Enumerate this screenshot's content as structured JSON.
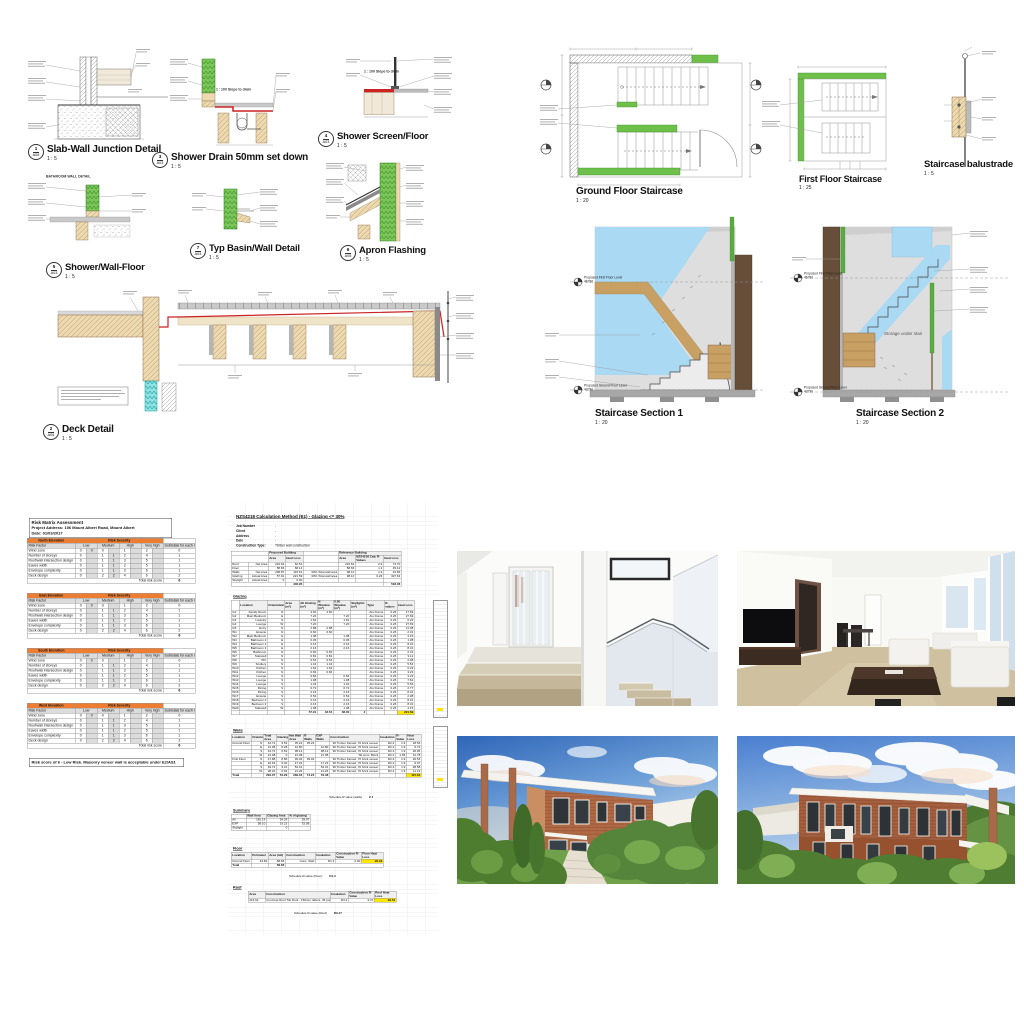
{
  "colors": {
    "accent_orange": "#ED7D31",
    "highlight_yellow": "#FFE600",
    "drawing_green": "#6EC04B",
    "section_blue": "#AAD9F3",
    "timber_tan": "#C8A064",
    "wall_brown": "#5A4532",
    "membrane_red": "#CC2222",
    "insulation_cyan": "#8FE3E3"
  },
  "details_sheet": {
    "bathroom_label": "BATHROOM WALL DETAIL",
    "slope_note": "1 : 100 Slope to drain",
    "details": [
      {
        "num": "1",
        "sheet": "A05",
        "title": "Slab-Wall Junction Detail",
        "scale": "1 : 5"
      },
      {
        "num": "3",
        "sheet": "A03",
        "title": "Shower Drain 50mm set down",
        "scale": "1 : 5"
      },
      {
        "num": "4",
        "sheet": "A03",
        "title": "Shower Screen/Floor",
        "scale": "1 : 5"
      },
      {
        "num": "5",
        "sheet": "A03",
        "title": "Shower/Wall-Floor",
        "scale": "1 : 5"
      },
      {
        "num": "7",
        "sheet": "A03",
        "title": "Typ Basin/Wall Detail",
        "scale": "1 : 5"
      },
      {
        "num": "6",
        "sheet": "A05",
        "title": "Apron Flashing",
        "scale": "1 : 5"
      },
      {
        "num": "2",
        "sheet": "A05",
        "title": "Deck Detail",
        "scale": "1 : 5"
      }
    ]
  },
  "stair_sheet": {
    "plans": [
      {
        "title": "Ground Floor Staircase",
        "scale": "1 : 20"
      },
      {
        "title": "First Floor Staircase",
        "scale": "1 : 25"
      },
      {
        "title": "Staircase balustrade",
        "scale": "1 : 5"
      }
    ],
    "sections": [
      {
        "title": "Staircase Section 1",
        "scale": "1 : 20"
      },
      {
        "title": "Staircase Section 2",
        "scale": "1 : 20"
      }
    ],
    "levels": {
      "first_floor": "Proposed First Floor Level",
      "first_floor_value": "46780",
      "ground_floor": "Proposed Ground Floor Level",
      "ground_floor_value": "43790"
    },
    "storage_note": "Storage under stair"
  },
  "risk_matrix": {
    "title": "Risk Matrix Assessment",
    "address": "Project Address: 106 Mount Albert Road, Mount Albert",
    "date": "Date: 01/03/2017",
    "note": "Risk score of 6 - Low Risk. Masonry veneer wall is acceptable under E2/AS1",
    "tables": [
      {
        "cells": [
          [
            "#North Elevation",
            "#@8@Risk Severity",
            ""
          ],
          [
            "~Risk Factor",
            "~@2@Low",
            "~@2@Medium",
            "~@2@High",
            "~@2@Very high",
            "~Subtotals for each risk factor"
          ],
          [
            "Wind zone",
            "0",
            "~0",
            "0",
            "~",
            "1",
            "~",
            "2",
            "~",
            "0"
          ],
          [
            "Number of storeys",
            "0",
            "~",
            "1",
            "~1",
            "2",
            "~",
            "4",
            "~",
            "1"
          ],
          [
            "Roof/wall intersection design",
            "0",
            "~",
            "1",
            "~1",
            "3",
            "~",
            "5",
            "~",
            "1"
          ],
          [
            "Eaves width",
            "0",
            "~",
            "1",
            "~1",
            "2",
            "~",
            "5",
            "~",
            "1"
          ],
          [
            "Envelope complexity",
            "0",
            "~",
            "1",
            "~1",
            "3",
            "~",
            "6",
            "~",
            "1"
          ],
          [
            "Deck design",
            "0",
            "~",
            "2",
            "~2",
            "4",
            "~",
            "6",
            "~",
            "2"
          ],
          [
            "$@9@Total risk score",
            "^6"
          ]
        ]
      },
      {
        "cells": [
          [
            "#East Elevation",
            "#@8@Risk Severity",
            ""
          ],
          [
            "~Risk Factor",
            "~@2@Low",
            "~@2@Medium",
            "~@2@High",
            "~@2@Very high",
            "~Subtotals for each risk factor"
          ],
          [
            "Wind zone",
            "0",
            "~0",
            "0",
            "~",
            "1",
            "~",
            "2",
            "~",
            "0"
          ],
          [
            "Number of storeys",
            "0",
            "~",
            "1",
            "~1",
            "2",
            "~",
            "4",
            "~",
            "1"
          ],
          [
            "Roof/wall intersection design",
            "0",
            "~",
            "1",
            "~1",
            "3",
            "~",
            "5",
            "~",
            "1"
          ],
          [
            "Eaves width",
            "0",
            "~",
            "1",
            "~1",
            "2",
            "~",
            "5",
            "~",
            "1"
          ],
          [
            "Envelope complexity",
            "0",
            "~",
            "1",
            "~1",
            "3",
            "~",
            "6",
            "~",
            "1"
          ],
          [
            "Deck design",
            "0",
            "~",
            "2",
            "~2",
            "4",
            "~",
            "6",
            "~",
            "2"
          ],
          [
            "$@9@Total risk score",
            "^6"
          ]
        ]
      },
      {
        "cells": [
          [
            "#South Elevation",
            "#@8@Risk Severity",
            ""
          ],
          [
            "~Risk Factor",
            "~@2@Low",
            "~@2@Medium",
            "~@2@High",
            "~@2@Very high",
            "~Subtotals for each risk factor"
          ],
          [
            "Wind zone",
            "0",
            "~0",
            "0",
            "~",
            "1",
            "~",
            "2",
            "~",
            "0"
          ],
          [
            "Number of storeys",
            "0",
            "~",
            "1",
            "~1",
            "2",
            "~",
            "4",
            "~",
            "1"
          ],
          [
            "Roof/wall intersection design",
            "0",
            "~",
            "1",
            "~1",
            "3",
            "~",
            "5",
            "~",
            "1"
          ],
          [
            "Eaves width",
            "0",
            "~",
            "1",
            "~1",
            "2",
            "~",
            "5",
            "~",
            "1"
          ],
          [
            "Envelope complexity",
            "0",
            "~",
            "1",
            "~1",
            "3",
            "~",
            "6",
            "~",
            "1"
          ],
          [
            "Deck design",
            "0",
            "~",
            "2",
            "~2",
            "4",
            "~",
            "6",
            "~",
            "2"
          ],
          [
            "$@9@Total risk score",
            "^6"
          ]
        ]
      },
      {
        "cells": [
          [
            "#West Elevation",
            "#@8@Risk Severity",
            ""
          ],
          [
            "~Risk Factor",
            "~@2@Low",
            "~@2@Medium",
            "~@2@High",
            "~@2@Very high",
            "~Subtotals for each risk factor"
          ],
          [
            "Wind zone",
            "0",
            "~0",
            "0",
            "~",
            "1",
            "~",
            "2",
            "~",
            "0"
          ],
          [
            "Number of storeys",
            "0",
            "~",
            "1",
            "~1",
            "2",
            "~",
            "4",
            "~",
            "1"
          ],
          [
            "Roof/wall intersection design",
            "0",
            "~",
            "1",
            "~1",
            "3",
            "~",
            "5",
            "~",
            "1"
          ],
          [
            "Eaves width",
            "0",
            "~",
            "1",
            "~1",
            "2",
            "~",
            "5",
            "~",
            "1"
          ],
          [
            "Envelope complexity",
            "0",
            "~",
            "1",
            "~1",
            "3",
            "~",
            "6",
            "~",
            "1"
          ],
          [
            "Deck design",
            "0",
            "~",
            "2",
            "~2",
            "4",
            "~",
            "6",
            "~",
            "2"
          ],
          [
            "$@9@Total risk score",
            "^6"
          ]
        ]
      }
    ]
  },
  "calc_sheet": {
    "title": "NZS4218 Calculation Method (E1) - Glazing <= 30%",
    "info": [
      {
        "label": "Job Number",
        "value": "-"
      },
      {
        "label": "Client",
        "value": "-"
      },
      {
        "label": "Address",
        "value": "-"
      },
      {
        "label": "Date",
        "value": "-"
      },
      {
        "label": "Construction Type:",
        "value": "Timber wall construction"
      }
    ],
    "labels": {
      "glazing": "Glazing",
      "walls": "Walls",
      "summary": "Summary",
      "floor": "Floor",
      "roof": "Roof"
    },
    "schedule_notes": {
      "walls_label": "Schedule R value (walls)",
      "walls_value": "2.1",
      "floor_label": "Schedule R-value (Floor)",
      "floor_value": "R1.3",
      "roof_label": "Schedule R-value (Roof)",
      "roof_value": "R3.47"
    },
    "building_summary": [
      [
        "@2@",
        "~@2@Proposed Building",
        "",
        "~@3@Reference Building"
      ],
      [
        "@2@",
        "~Area",
        "~Heat Loss",
        "",
        "~Area",
        "~NZS4218 Calc R-Values",
        "~Heat Loss"
      ],
      [
        "Roof",
        "Net Area",
        "216.62",
        "62.51",
        "",
        "216.62",
        "2.9",
        "74.70"
      ],
      [
        "Floor",
        "",
        "58.66",
        "68.14",
        "",
        "58.66",
        "1.3",
        "45.12"
      ],
      [
        "Walls",
        "Net Area",
        "238.87",
        "115.61",
        "30% Total wall area",
        "98.10",
        "1.9",
        "44.83"
      ],
      [
        "Glazing",
        "Actual Area",
        "57.91",
        "221.59",
        "30% Total wall area",
        "98.10",
        "0.26",
        "327.64"
      ],
      [
        "Skylight",
        "Actual Area",
        "0",
        "0.00",
        "",
        "",
        "",
        ""
      ],
      [
        "@3@",
        "^446.95",
        "@3@",
        "^518.06"
      ]
    ],
    "glazing_table": [
      [
        "",
        "~Location",
        "~Orientation",
        "~Area (m²)",
        "~All Glazing (m²)",
        "~N Window (m²)",
        "~0.50 Window (m²)",
        "~Skylights (m²)",
        "~Type",
        "~R-values",
        "~Heat Loss"
      ],
      [
        "G1",
        "Family Room",
        "N",
        "",
        "4.60",
        "4.60",
        "",
        "",
        "Alu Frame",
        "0.26",
        "17.69"
      ],
      [
        "G2",
        "Main Bedroom",
        "E",
        "",
        "7.20",
        "",
        "7.20",
        "",
        "Alu Frame",
        "0.26",
        "27.69"
      ],
      [
        "G3",
        "Laundry",
        "S",
        "",
        "1.62",
        "",
        "1.62",
        "",
        "Alu Frame",
        "0.26",
        "6.23"
      ],
      [
        "G4",
        "Lounge",
        "W",
        "",
        "7.20",
        "",
        "7.20",
        "",
        "Alu Frame",
        "0.26",
        "27.69"
      ],
      [
        "G5",
        "Entry",
        "N",
        "",
        "2.88",
        "2.88",
        "",
        "",
        "Alu Frame",
        "0.26",
        "11.08"
      ],
      [
        "W1",
        "Ensuite",
        "N",
        "",
        "0.60",
        "0.60",
        "",
        "",
        "Alu Frame",
        "0.26",
        "2.31"
      ],
      [
        "W2",
        "Main Bedroom",
        "E",
        "",
        "1.08",
        "",
        "1.08",
        "",
        "Alu Frame",
        "0.26",
        "4.15"
      ],
      [
        "W3",
        "Bathroom 2",
        "E",
        "",
        "0.36",
        "",
        "0.36",
        "",
        "Alu Frame",
        "0.26",
        "1.38"
      ],
      [
        "W4",
        "Bathroom 2",
        "E",
        "",
        "2.16",
        "",
        "2.16",
        "",
        "Alu Frame",
        "0.26",
        "8.31"
      ],
      [
        "W5",
        "Bathroom 3",
        "E",
        "",
        "2.16",
        "",
        "2.16",
        "",
        "Alu Frame",
        "0.26",
        "8.31"
      ],
      [
        "W6",
        "Bathroom",
        "N",
        "",
        "0.60",
        "0.60",
        "",
        "",
        "Alu Frame",
        "0.26",
        "2.31"
      ],
      [
        "W7",
        "Stairwell",
        "N",
        "",
        "0.81",
        "0.81",
        "",
        "",
        "Alu Frame",
        "0.26",
        "3.12"
      ],
      [
        "W8",
        "WC",
        "N",
        "",
        "0.54",
        "0.54",
        "",
        "",
        "Alu Frame",
        "0.26",
        "2.08"
      ],
      [
        "W9",
        "Scullery",
        "N",
        "",
        "1.44",
        "1.44",
        "",
        "",
        "Alu Frame",
        "0.26",
        "5.54"
      ],
      [
        "W10",
        "Kitchen",
        "N",
        "",
        "1.62",
        "1.62",
        "",
        "",
        "Alu Frame",
        "0.26",
        "6.23"
      ],
      [
        "W11",
        "Kitchen",
        "N",
        "",
        "0.84",
        "0.84",
        "",
        "",
        "Alu Frame",
        "0.26",
        "3.23"
      ],
      [
        "W12",
        "Lounge",
        "S",
        "",
        "0.84",
        "",
        "0.84",
        "",
        "Alu Frame",
        "0.26",
        "3.23"
      ],
      [
        "W13",
        "Lounge",
        "S",
        "",
        "1.98",
        "",
        "1.98",
        "",
        "Alu Frame",
        "0.26",
        "7.62"
      ],
      [
        "W14",
        "Lounge",
        "S",
        "",
        "1.44",
        "",
        "1.44",
        "",
        "Alu Frame",
        "0.26",
        "5.54"
      ],
      [
        "W15",
        "Dining",
        "S",
        "",
        "0.72",
        "",
        "0.72",
        "",
        "Alu Frame",
        "0.26",
        "2.77"
      ],
      [
        "W16",
        "Dining",
        "S",
        "",
        "2.16",
        "",
        "2.16",
        "",
        "Alu Frame",
        "0.26",
        "8.31"
      ],
      [
        "W17",
        "Ensuite",
        "S",
        "",
        "0.54",
        "",
        "0.54",
        "",
        "Alu Frame",
        "0.26",
        "2.08"
      ],
      [
        "W18",
        "Bedroom 2",
        "S",
        "",
        "2.16",
        "",
        "2.16",
        "",
        "Alu Frame",
        "0.26",
        "8.31"
      ],
      [
        "W19",
        "Bedroom 3",
        "S",
        "",
        "2.16",
        "",
        "2.16",
        "",
        "Alu Frame",
        "0.26",
        "8.31"
      ],
      [
        "W20",
        "Stairwell",
        "W",
        "",
        "1.08",
        "",
        "1.08",
        "",
        "Alu Frame",
        "0.26",
        "4.15"
      ],
      [
        "",
        "",
        "",
        "",
        "^57.91",
        "^43.54",
        "^38.00",
        "^2",
        "",
        "",
        "!221.59"
      ]
    ],
    "walls_table": [
      [
        "~Location",
        "~Orientation",
        "~Total Area",
        "~Glazing",
        "~Net Wall Area",
        "~R Walls",
        "~EXP Walls",
        "~Construction",
        "~Insulation",
        "~R-Value",
        "~Heat Loss"
      ],
      [
        "Ground Floor",
        "N",
        "44.74",
        "9.52",
        "35.22",
        "35.22",
        "",
        "90 Timber framed, 70 brick veneer",
        "R2.2",
        "1.9",
        "18.54"
      ],
      [
        "",
        "E",
        "21.08",
        "8.28",
        "12.80",
        "",
        "12.80",
        "90 Timber framed, 70 brick veneer",
        "R2.2",
        "1.9",
        "6.74"
      ],
      [
        "",
        "S",
        "44.74",
        "6.62",
        "38.12",
        "",
        "38.12",
        "90 Timber framed, 70 brick veneer",
        "R2.2",
        "1.9",
        "20.06"
      ],
      [
        "",
        "W",
        "21.08",
        "0",
        "21.08",
        "",
        "21.08",
        "Tilt conc. Block",
        "R2.2",
        "1.65",
        "12.78"
      ],
      [
        "First Floor",
        "N",
        "47.88",
        "8.86",
        "39.02",
        "39.02",
        "",
        "90 Timber framed, 70 brick veneer",
        "R2.2",
        "1.9",
        "20.54"
      ],
      [
        "",
        "E",
        "22.63",
        "5.40",
        "17.23",
        "",
        "17.23",
        "90 Timber framed, 70 brick veneer",
        "R2.2",
        "1.9",
        "9.07"
      ],
      [
        "",
        "S",
        "63.72",
        "9.41",
        "54.31",
        "",
        "54.31",
        "90 Timber framed, 70 brick veneer",
        "R2.2",
        "1.9",
        "28.58"
      ],
      [
        "",
        "W",
        "28.20",
        "6.94",
        "21.26",
        "",
        "21.26",
        "90 Timber framed, 70 brick veneer",
        "R2.2",
        "1.9",
        "11.19"
      ],
      [
        "^Total",
        "",
        "^294.07",
        "^54.29",
        "^239.04",
        "^74.24",
        "^79.48",
        "",
        "",
        "",
        "!115.61"
      ]
    ],
    "summary_table": [
      [
        "",
        "~Wall Area",
        "~Glazing Area",
        "~% of glazing"
      ],
      [
        "All",
        "181.19",
        "54.29",
        "29.97"
      ],
      [
        "EXP",
        "58.10",
        "19.22",
        "33.08"
      ],
      [
        "Skylight",
        "",
        "0",
        ""
      ]
    ],
    "floor_table": [
      [
        "~Location",
        "~Perimeter",
        "~Area (m2)",
        "~Construction",
        "~Insulation",
        "~Construction R-Value",
        "~Floor Heat Loss"
      ],
      [
        "Ground Floor",
        "44.82",
        "58.66",
        "Conc. Slab",
        "R1.3",
        "2.00",
        "!29.33"
      ],
      [
        "^Total",
        "",
        "^58.66",
        "@4@"
      ]
    ],
    "roof_table": [
      [
        "~Area",
        "~Construction",
        "~Insulation",
        "~Construction R-Value",
        "~Roof Heat Loss"
      ],
      [
        "216.62",
        "Concrete Roof Tile Roof - 150mm rafters, 45 purlin",
        "R3.2",
        "3.47",
        "!62.51"
      ]
    ]
  }
}
